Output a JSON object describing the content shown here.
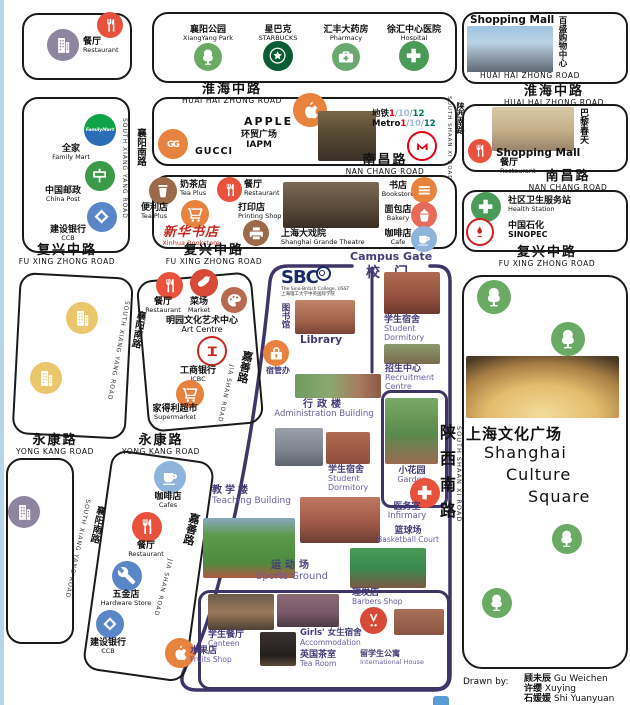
{
  "palette": {
    "paper": "#ffffff",
    "ink": "#1a1a1a",
    "campus_purple": "#3f3566",
    "accent_red": "#e8513b",
    "accent_orange": "#e8823f",
    "green": "#6aaa64",
    "starbucks_green": "#0a5c34",
    "cafe_blue": "#8fb4dc",
    "brown": "#9a6a4a",
    "building_gray": "#8e86a0",
    "building_yellow": "#eac76d",
    "metro_red": "#e60012",
    "line1": "#e60012",
    "line10": "#9fc0dd",
    "line12": "#007b63",
    "ccb_blue": "#5a86c8",
    "icbc_red": "#c8281e",
    "post_green": "#3a9a4a",
    "xinhua_red": "#c42a20",
    "edge_blue": "#b8d6ea"
  },
  "roads": {
    "huaihai": {
      "zh": "淮海中路",
      "en": "HUAI HAI ZHONG ROAD"
    },
    "nanchang": {
      "zh": "南昌路",
      "en": "NAN CHANG ROAD"
    },
    "fuxing": {
      "zh": "复兴中路",
      "en": "FU XING ZHONG ROAD"
    },
    "yongkang": {
      "zh": "永康路",
      "en": "YONG KANG ROAD"
    },
    "xiangyang": {
      "zh": "襄阳南路",
      "en": "SOUTH XIANG YANG ROAD"
    },
    "jiashan": {
      "zh": "嘉善路",
      "en": "JIA SHAN ROAD"
    },
    "shaanxi": {
      "zh": "陕西南路",
      "en": "SOUTH SHAAN XI ROAD"
    }
  },
  "nw": {
    "restaurant": {
      "zh": "餐厅",
      "en": "Restaurant"
    }
  },
  "amenities": {
    "park": {
      "zh": "襄阳公园",
      "en": "XiangYang Park"
    },
    "starbucks": {
      "zh": "星巴克",
      "en": "STARBUCKS"
    },
    "pharmacy": {
      "zh": "汇丰大药房",
      "en": "Pharmacy"
    },
    "hospital": {
      "zh": "徐汇中心医院",
      "en": "Hospital"
    }
  },
  "parkson": {
    "title": "Shopping Mall",
    "vertical_zh": "百盛购物中心"
  },
  "luxury": {
    "apple": "APPLE",
    "gucci": "GUCCI",
    "iapm": {
      "zh": "环贸广场",
      "en": "IAPM"
    },
    "metro": {
      "zh": "地铁",
      "en": "Metro",
      "l1": "1",
      "l10": "10",
      "l12": "12",
      "sep": "/"
    }
  },
  "midshops": {
    "teaplus": {
      "zh": "奶茶店",
      "en": "Tea Plus"
    },
    "restaurant": {
      "zh": "餐厅",
      "en": "Restaurant"
    },
    "convenience": {
      "zh": "便利店",
      "en": "Tea Plus"
    },
    "xinhua": {
      "zh": "新华书店",
      "en": "Xinhua Bookstore"
    },
    "printing": {
      "zh": "打印店",
      "en": "Printing Shop"
    },
    "theatre": {
      "zh": "上海大戏院",
      "en": "Shanghai Grande Theatre"
    },
    "bookstore": {
      "zh": "书店",
      "en": "Bookstore"
    },
    "bakery": {
      "zh": "面包店",
      "en": "Bakery"
    },
    "cafe": {
      "zh": "咖啡店",
      "en": "Cafe"
    }
  },
  "west": {
    "familymart": {
      "zh": "全家",
      "en": "Family Mart",
      "logo": "FamilyMart"
    },
    "chinapost": {
      "zh": "中国邮政",
      "en": "China Post"
    },
    "ccb": {
      "zh": "建设银行",
      "en": "CCB"
    }
  },
  "art": {
    "restaurant": {
      "zh": "餐厅",
      "en": "Restaurant"
    },
    "market": {
      "zh": "菜场",
      "en": "Market"
    },
    "centre": {
      "zh": "明园文化艺术中心",
      "en": "Art Centre"
    },
    "icbc": {
      "zh": "工商银行",
      "en": "ICBC"
    },
    "supermarket": {
      "zh": "家得利超市",
      "en": "Supermarket"
    }
  },
  "southwest": {
    "cafes": {
      "zh": "咖啡店",
      "en": "Cafes"
    },
    "restaurant": {
      "zh": "餐厅",
      "en": "Restaurant"
    },
    "hardware": {
      "zh": "五金店",
      "en": "Hardware Store"
    },
    "ccb": {
      "zh": "建设银行",
      "en": "CCB"
    }
  },
  "east": {
    "printemps": {
      "title": "Shopping Mall",
      "vertical_zh": "巴黎春天",
      "restaurant": {
        "zh": "餐厅",
        "en": "Restaurant"
      }
    },
    "health": {
      "zh": "社区卫生服务站",
      "en": "Health Station"
    },
    "sinopec": {
      "zh": "中国石化",
      "en": "SINOPEC"
    },
    "culture": {
      "zh": "上海文化广场",
      "en1": "Shanghai",
      "en2": "Culture",
      "en3": "Square"
    }
  },
  "campus": {
    "gate": {
      "en": "Campus Gate",
      "zh": "校门"
    },
    "sbc": {
      "name": "SBC",
      "sub_en": "The Sino-British College, USST",
      "sub_zh": "上海理工大学中英国际学院"
    },
    "library": {
      "zh": "图书馆",
      "en": "Library"
    },
    "dorm_office": {
      "zh": "宿管办"
    },
    "dorm1": {
      "zh": "学生宿舍",
      "en1": "Student",
      "en2": "Dormitory"
    },
    "recruitment": {
      "zh": "招生中心",
      "en1": "Recruitment",
      "en2": "Centre"
    },
    "admin": {
      "zh": "行政楼",
      "en": "Administration Building"
    },
    "dorm2": {
      "zh": "学生宿舍",
      "en1": "Student",
      "en2": "Dormitory"
    },
    "garden": {
      "zh": "小花园",
      "en": "Garden"
    },
    "infirmary": {
      "zh": "医务室",
      "en": "Infirmary"
    },
    "teaching": {
      "zh": "教学楼",
      "en": "Teaching Building"
    },
    "basketball": {
      "zh": "篮球场",
      "en": "Basketball Court"
    },
    "sports": {
      "zh": "运动场",
      "en": "Sports Ground"
    },
    "barbers": {
      "zh": "理发店",
      "en": "Barbers Shop"
    },
    "canteen": {
      "zh": "学生餐厅",
      "en": "Canteen"
    },
    "girls": {
      "zh": "Girls' 女生宿舍",
      "en": "Accommodation"
    },
    "fruits": {
      "zh": "水果店",
      "en": "Fruits Shop"
    },
    "tearoom": {
      "zh": "英国茶室",
      "en": "Tea Room"
    },
    "intl": {
      "zh": "留学生公寓",
      "en": "International House"
    }
  },
  "credits": {
    "label": "Drawn by:",
    "names": [
      {
        "zh": "顾未辰",
        "en": "Gu Weichen"
      },
      {
        "zh": "许缨",
        "en": "Xuying"
      },
      {
        "zh": "石媛媛",
        "en": "Shi Yuanyuan"
      }
    ]
  }
}
